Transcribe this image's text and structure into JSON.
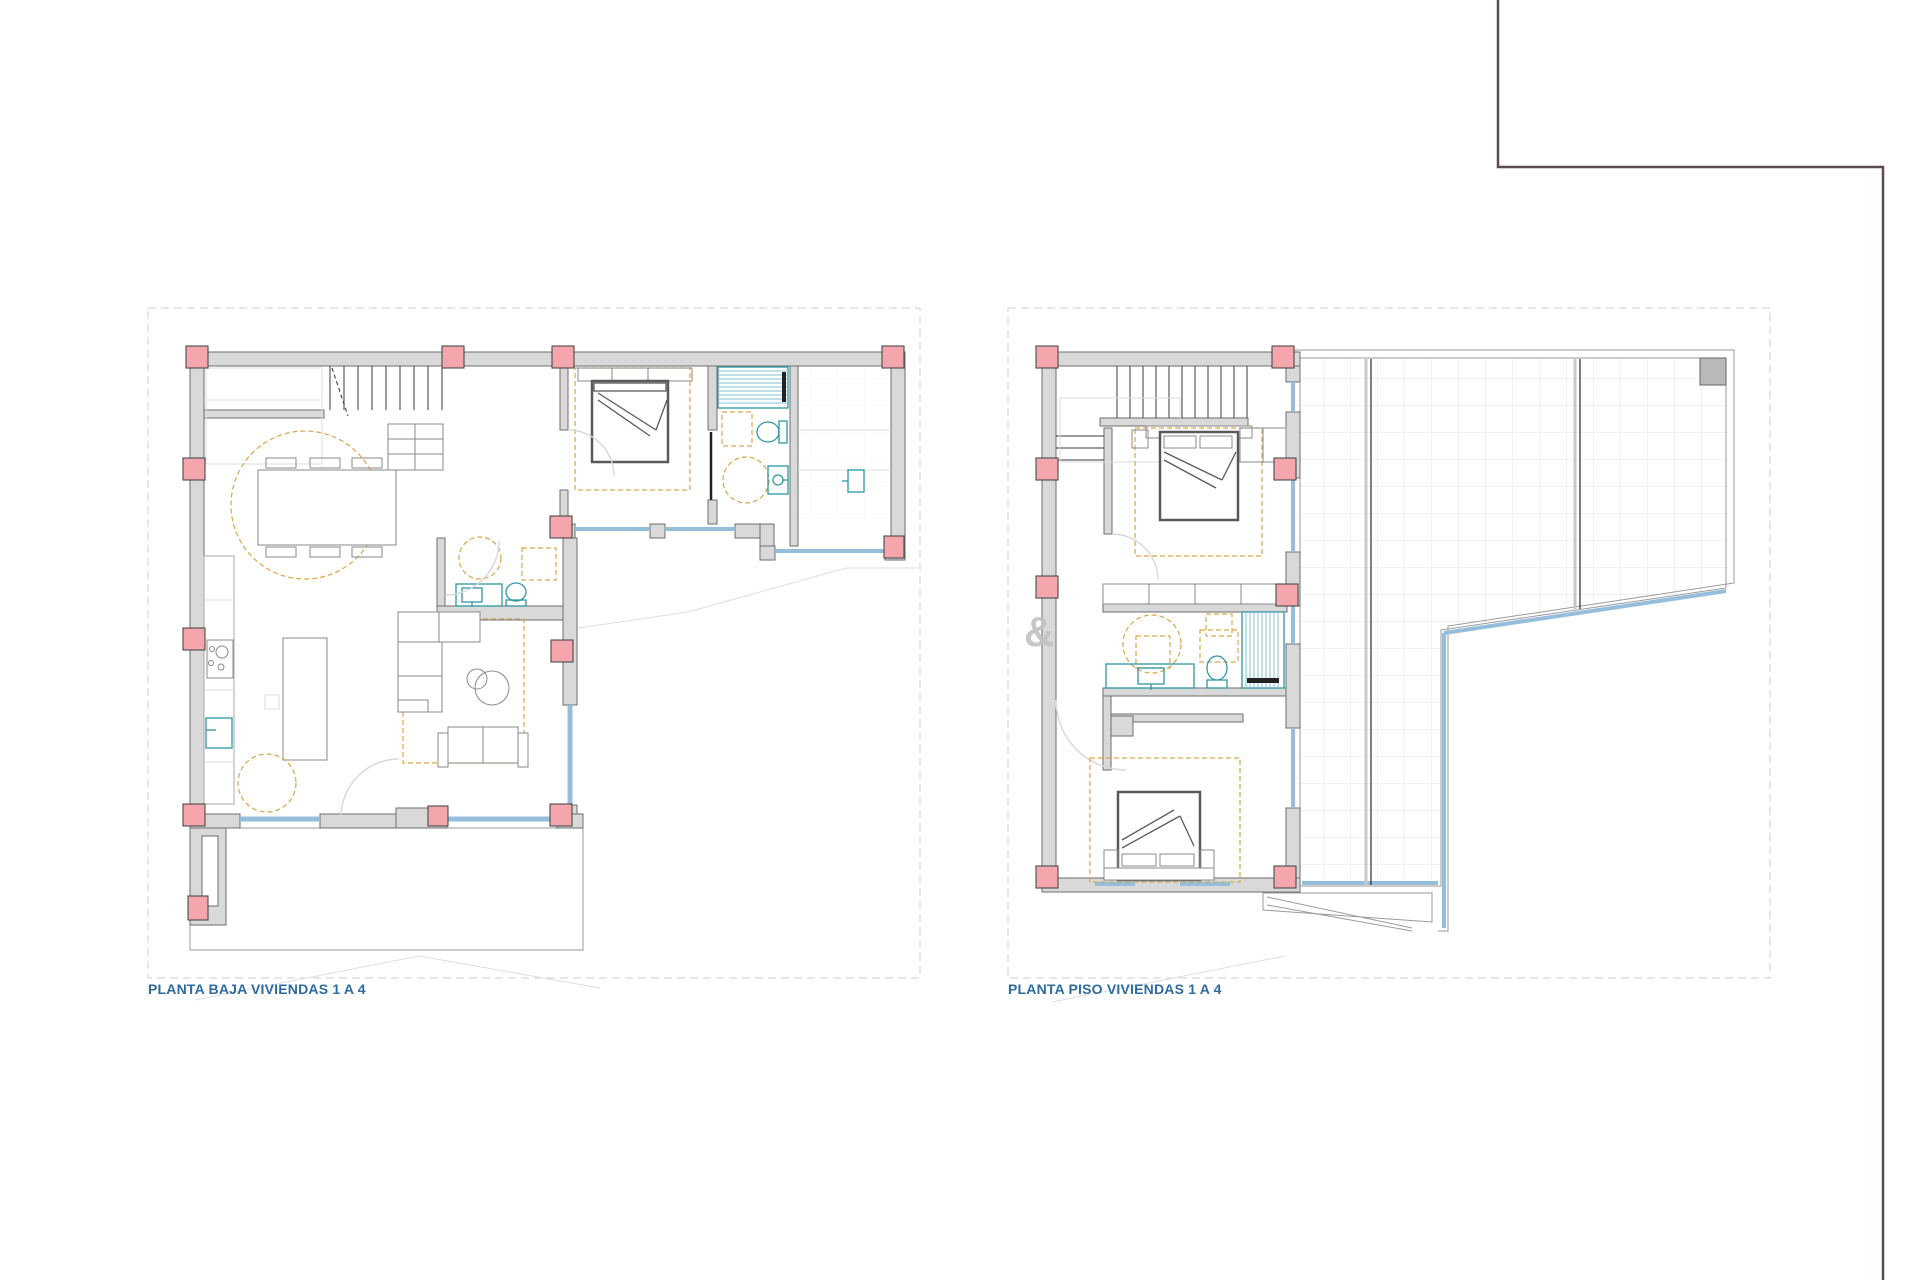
{
  "page": {
    "background_color": "#ffffff"
  },
  "frame": {
    "color": "#5c4a52"
  },
  "watermark": {
    "text": "&",
    "color": "#c2c2c2"
  },
  "palette": {
    "page_bg": "#ffffff",
    "wall_fill": "#d9d9d9",
    "wall_stroke": "#6e6e6e",
    "column_fill": "#f4a6ac",
    "column_stroke": "#4a4a4a",
    "window_blue": "#95bedd",
    "fixture_teal": "#2e98a6",
    "furniture_gray": "#8a8a8a",
    "bed_gray": "#5a5a5a",
    "zone_dash_orange": "#d9a64a",
    "plot_dash_gray": "#cfcfcf",
    "terrace_grid": "#e6e6e6",
    "label_blue": "#2e6b9e",
    "frame_color": "#5c4a52",
    "watermark_color": "#c2c2c2"
  },
  "plans": [
    {
      "id": "planta-baja",
      "title": "PLANTA BAJA VIVIENDAS 1 A 4",
      "features": [
        "stairs",
        "dining-table",
        "dining-chairs",
        "kitchen-counter",
        "stove",
        "kitchen-sink",
        "kitchen-island",
        "l-sofa",
        "two-seat-sofa",
        "coffee-tables",
        "wc-toilet",
        "wc-washbasin",
        "double-bed",
        "shower",
        "bathroom-toilet",
        "bathroom-washbasin",
        "porch",
        "windows",
        "columns",
        "entrance-door"
      ]
    },
    {
      "id": "planta-piso",
      "title": "PLANTA PISO VIVIENDAS 1 A 4",
      "features": [
        "stairs",
        "bedroom-1-double-bed",
        "wardrobe",
        "closet",
        "bathroom-vanity",
        "bathroom-toilet",
        "shower",
        "bedroom-2-double-bed",
        "terrace",
        "terrace-grid",
        "roof-edge",
        "glass-railing",
        "chimney",
        "windows",
        "columns"
      ]
    }
  ]
}
